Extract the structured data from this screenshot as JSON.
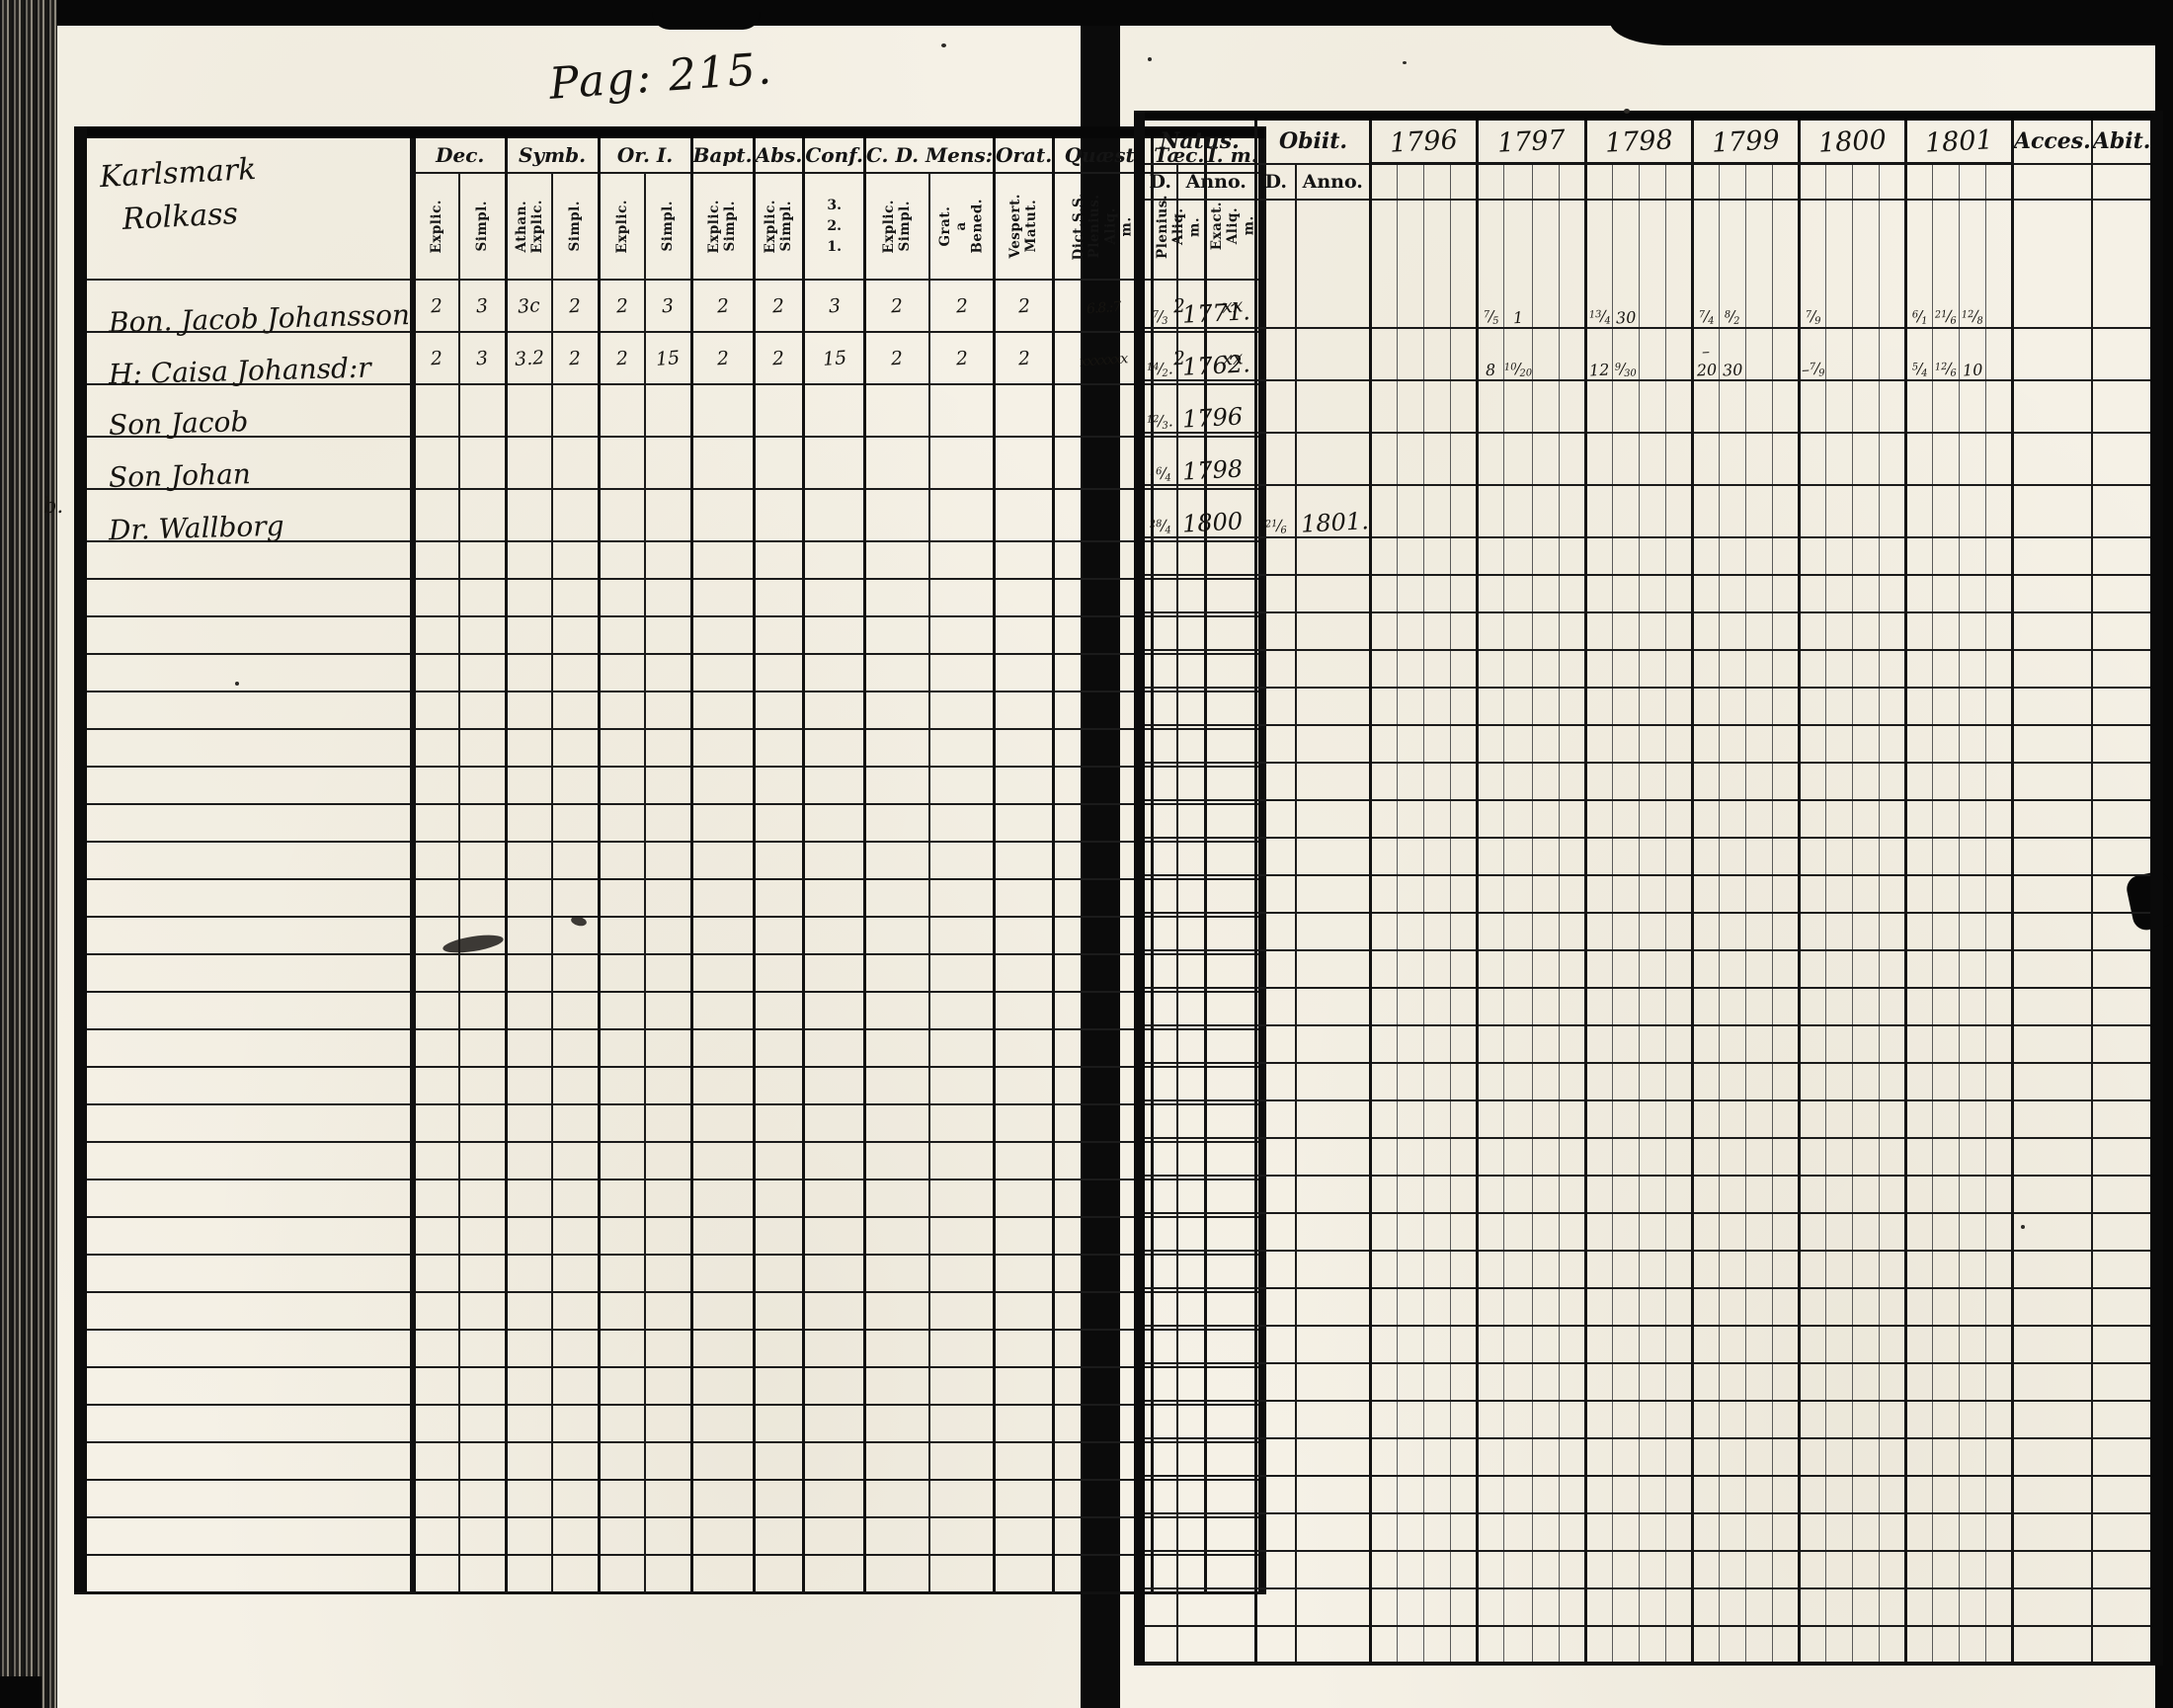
{
  "page_label": "Pag: 215.",
  "left_page": {
    "place_name_line1": "Karlsmark",
    "place_name_line2": "Rolkass",
    "column_groups": [
      {
        "label": "Dec.",
        "subs": [
          "Explic.",
          "Simpl."
        ]
      },
      {
        "label": "Symb.",
        "subs": [
          "Athan. Explic.",
          "Simpl."
        ]
      },
      {
        "label": "Or. I.",
        "subs": [
          "Explic.",
          "Simpl."
        ]
      },
      {
        "label": "Bapt.",
        "subs": [
          "Explic. Simpl."
        ]
      },
      {
        "label": "Abs.",
        "subs": [
          "Explic. Simpl."
        ]
      },
      {
        "label": "Conf.",
        "subs": [
          "3. 2. 1."
        ]
      },
      {
        "label": "C. D. Mens:",
        "subs": [
          "Explic. Simpl.",
          "Grat. a Bened."
        ]
      },
      {
        "label": "Orat.",
        "subs": [
          "Vespert. Matut."
        ]
      },
      {
        "label": "Quæst.",
        "subs": [
          "Dict.S.S. Plenius. Aliq. m."
        ]
      },
      {
        "label": "Tæc.",
        "subs": [
          "Plenius. Aliq. m."
        ]
      },
      {
        "label": "I. m.",
        "subs": [
          "Exact. Aliq. m."
        ]
      }
    ],
    "rows": [
      {
        "margin": "",
        "name": "Bon. Jacob Johansson",
        "marks": [
          "2",
          "3",
          "3c",
          "2",
          "2",
          "3",
          "2",
          "2",
          "3",
          "2",
          "2",
          "2",
          "6.8.:7",
          "2",
          "xx"
        ]
      },
      {
        "margin": "",
        "name": "H: Caisa Johansd:r",
        "marks": [
          "2",
          "3",
          "3.2",
          "2",
          "2",
          "15",
          "2",
          "2",
          "15",
          "2",
          "2",
          "2",
          "xxxxxxx",
          "2",
          "xx"
        ]
      },
      {
        "margin": "",
        "name": "Son Jacob",
        "marks": []
      },
      {
        "margin": "",
        "name": "Son Johan",
        "marks": []
      },
      {
        "margin": "b.",
        "name": "Dr. Wallborg",
        "marks": []
      }
    ]
  },
  "right_page": {
    "natus_label": "Natus.",
    "obiit_label": "Obiit.",
    "sub_headers": [
      "D.",
      "Anno.",
      "D.",
      "Anno."
    ],
    "years": [
      "1796",
      "1797",
      "1798",
      "1799",
      "1800",
      "1801"
    ],
    "acces_label": "Acces.",
    "abit_label": "Abit.",
    "rows": [
      {
        "natus_d": "7/3",
        "natus_anno": "1771.",
        "obiit_d": "",
        "obiit_anno": "",
        "year_marks": {
          "1797": [
            "7/5",
            "1"
          ],
          "1798": [
            "13/4",
            "30"
          ],
          "1799": [
            "7/4",
            "8/2"
          ],
          "1800": [
            "7/9"
          ],
          "1801": [
            "6/1",
            "21/6",
            "12/8"
          ]
        }
      },
      {
        "natus_d": "14/2.",
        "natus_anno": "1762.",
        "obiit_d": "",
        "obiit_anno": "",
        "year_marks": {
          "1797": [
            "8",
            "10/20"
          ],
          "1798": [
            "12",
            "9/30"
          ],
          "1799": [
            "–20",
            "30"
          ],
          "1800": [
            "–7/9"
          ],
          "1801": [
            "5/4",
            "12/6",
            "10"
          ]
        }
      },
      {
        "natus_d": "12/3.",
        "natus_anno": "1796",
        "obiit_d": "",
        "obiit_anno": "",
        "year_marks": {}
      },
      {
        "natus_d": "16/4",
        "natus_anno": "1798",
        "obiit_d": "",
        "obiit_anno": "",
        "year_marks": {}
      },
      {
        "natus_d": "28/4",
        "natus_anno": "1800",
        "obiit_d": "21/6",
        "obiit_anno": "1801.",
        "year_marks": {}
      }
    ]
  }
}
